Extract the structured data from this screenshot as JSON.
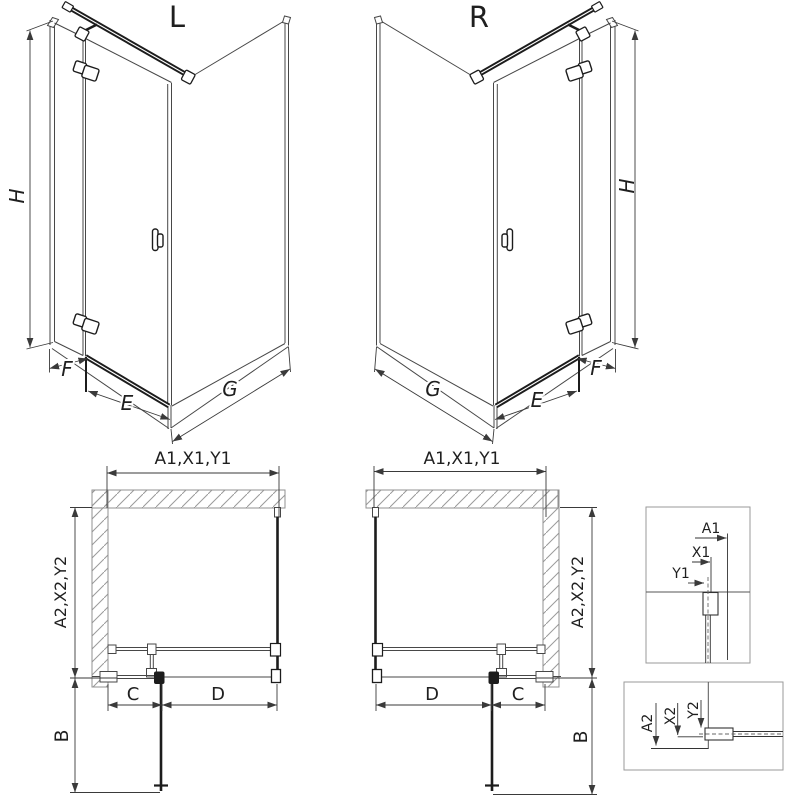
{
  "labels": {
    "variant_left": "L",
    "variant_right": "R",
    "height": "H",
    "front_fixed": "F",
    "door": "E",
    "side_panel": "G",
    "width_dims": "A1,X1,Y1",
    "depth_dims": "A2,X2,Y2",
    "door_open_depth": "B",
    "fixed_segment": "C",
    "door_segment": "D"
  },
  "detail_top": {
    "a1": "A1",
    "x1": "X1",
    "y1": "Y1"
  },
  "detail_bottom": {
    "a2": "A2",
    "x2": "X2",
    "y2": "Y2"
  },
  "colors": {
    "background": "#ffffff",
    "line": "#474747",
    "dark_profile": "#1c1c1c",
    "wall_hatch": "#9a9a9a",
    "dimension": "#3a3a3a"
  }
}
